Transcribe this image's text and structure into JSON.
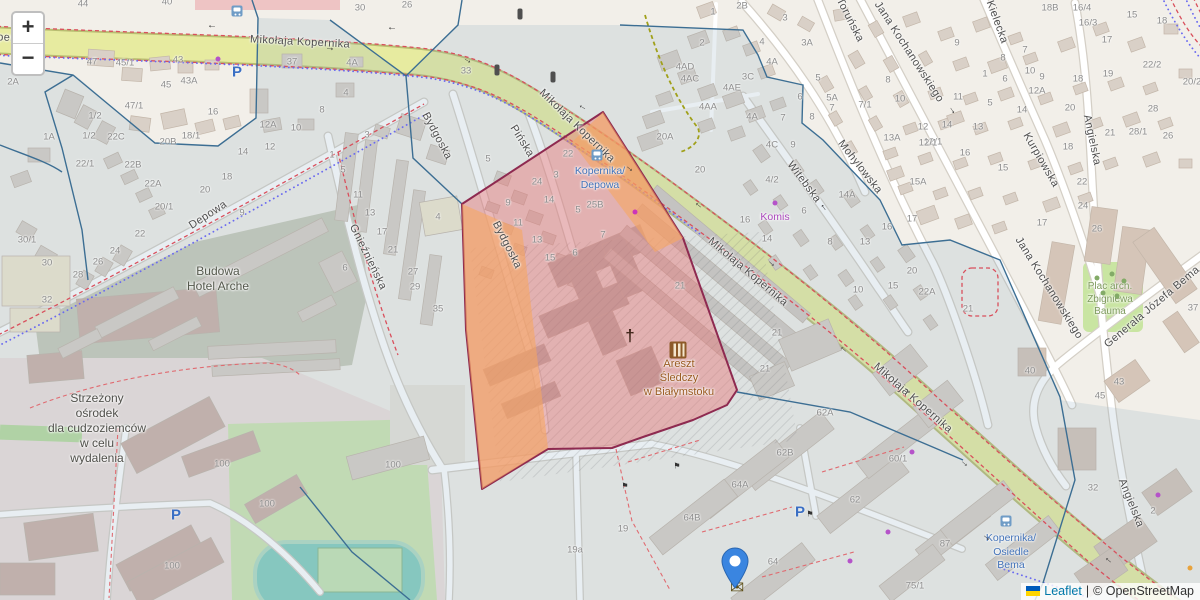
{
  "map": {
    "controls": {
      "zoom_in": "+",
      "zoom_out": "−"
    },
    "attribution": {
      "leaflet": "Leaflet",
      "separator": "|",
      "osm": "© OpenStreetMap",
      "flag_top": "#005BBB",
      "flag_bottom": "#FFD500"
    },
    "colors": {
      "selection_fill": "rgba(234,112,112,0.42)",
      "selection_stroke": "#8e2a50",
      "orange_fill": "rgba(246,166,96,0.6)",
      "marker_blue": "#3a85e0",
      "road_yellow": "#e7eba0"
    },
    "marker": {
      "x": 735,
      "y": 588
    },
    "street_labels": [
      {
        "t": "Mikołaja Kopernika",
        "x": -14,
        "y": 37,
        "r": 2
      },
      {
        "t": "Mikołaja Kopernika",
        "x": 300,
        "y": 42,
        "r": 3
      },
      {
        "t": "Mikołaja Kopernika",
        "x": 577,
        "y": 126,
        "r": 44
      },
      {
        "t": "Mikołaja Kopernika",
        "x": 748,
        "y": 272,
        "r": 40
      },
      {
        "t": "Mikołaja Kopernika",
        "x": 913,
        "y": 398,
        "r": 41
      },
      {
        "t": "Bydgoska",
        "x": 437,
        "y": 136,
        "r": 62
      },
      {
        "t": "Bydgoska",
        "x": 507,
        "y": 245,
        "r": 63
      },
      {
        "t": "Pińska",
        "x": 522,
        "y": 141,
        "r": 58
      },
      {
        "t": "Depowa",
        "x": 208,
        "y": 215,
        "r": -33
      },
      {
        "t": "Gnieźnieńska",
        "x": 368,
        "y": 257,
        "r": 64
      },
      {
        "t": "Witebska",
        "x": 804,
        "y": 182,
        "r": 53
      },
      {
        "t": "Mohylowska",
        "x": 860,
        "y": 167,
        "r": 52
      },
      {
        "t": "Toruńska",
        "x": 850,
        "y": 20,
        "r": 63
      },
      {
        "t": "Jana Kochanowskiego",
        "x": 909,
        "y": 52,
        "r": 57
      },
      {
        "t": "Jana Kochanowskiego",
        "x": 1049,
        "y": 288,
        "r": 58
      },
      {
        "t": "Kielecka",
        "x": 997,
        "y": 22,
        "r": 70
      },
      {
        "t": "Kurpiowska",
        "x": 1041,
        "y": 160,
        "r": 60
      },
      {
        "t": "Angielska",
        "x": 1092,
        "y": 140,
        "r": 78
      },
      {
        "t": "Angielska",
        "x": 1131,
        "y": 503,
        "r": 68
      },
      {
        "t": "Generała Józefa Bema",
        "x": 1152,
        "y": 307,
        "r": -40
      }
    ],
    "place_labels": [
      {
        "name": "construction-label",
        "lines": [
          "Budowa",
          "Hotel Arche"
        ],
        "x": 218,
        "y": 264,
        "color": "#54584c",
        "size": 12,
        "lh": 15
      },
      {
        "name": "detention-centre-label",
        "lines": [
          "Strzeżony",
          "ośrodek",
          "dla cudzoziemców",
          "w celu",
          "wydalenia"
        ],
        "x": 97,
        "y": 391,
        "color": "#4f4f4a",
        "size": 12,
        "lh": 15
      },
      {
        "name": "prison-label",
        "lines": [
          "Areszt",
          "Śledczy",
          "w Białymstoku"
        ],
        "x": 679,
        "y": 357,
        "color": "#9a5b21",
        "size": 11,
        "lh": 14
      },
      {
        "name": "bus-stop-kopernika-depowa",
        "lines": [
          "Kopernika/",
          "Depowa"
        ],
        "x": 600,
        "y": 165,
        "color": "#4272b8",
        "size": 10.5,
        "lh": 13.5
      },
      {
        "name": "bus-stop-kopernika-osiedle-bema",
        "lines": [
          "Kopernika/",
          "Osiedle",
          "Bema"
        ],
        "x": 1011,
        "y": 532,
        "color": "#4272b8",
        "size": 10.5,
        "lh": 13.5
      },
      {
        "name": "shop-komis-label",
        "lines": [
          "Komis"
        ],
        "x": 775,
        "y": 211,
        "color": "#ab47bc",
        "size": 10.5,
        "lh": 13
      },
      {
        "name": "park-bauma-label",
        "lines": [
          "Plac arch.",
          "Zbigniewa",
          "Bauma"
        ],
        "x": 1110,
        "y": 281,
        "color": "#7d9a5c",
        "size": 10,
        "lh": 12.5
      }
    ],
    "house_numbers": [
      [
        83,
        4,
        "44"
      ],
      [
        167,
        2,
        "40"
      ],
      [
        92,
        62,
        "47"
      ],
      [
        125,
        63,
        "45/1"
      ],
      [
        178,
        60,
        "43"
      ],
      [
        166,
        85,
        "45"
      ],
      [
        189,
        81,
        "43A"
      ],
      [
        292,
        62,
        "37"
      ],
      [
        213,
        112,
        "16"
      ],
      [
        134,
        106,
        "47/1"
      ],
      [
        95,
        116,
        "1/2"
      ],
      [
        89,
        136,
        "1/2"
      ],
      [
        49,
        137,
        "1A"
      ],
      [
        116,
        137,
        "22C"
      ],
      [
        268,
        125,
        "12A"
      ],
      [
        296,
        128,
        "10"
      ],
      [
        168,
        142,
        "20B"
      ],
      [
        191,
        136,
        "18/1"
      ],
      [
        13,
        82,
        "2A"
      ],
      [
        85,
        164,
        "22/1"
      ],
      [
        133,
        165,
        "22B"
      ],
      [
        153,
        184,
        "22A"
      ],
      [
        164,
        207,
        "20/1"
      ],
      [
        140,
        234,
        "22"
      ],
      [
        115,
        251,
        "24"
      ],
      [
        98,
        262,
        "26"
      ],
      [
        78,
        275,
        "28"
      ],
      [
        27,
        240,
        "30/1"
      ],
      [
        47,
        263,
        "30"
      ],
      [
        47,
        300,
        "32"
      ],
      [
        322,
        110,
        "8"
      ],
      [
        243,
        152,
        "14"
      ],
      [
        270,
        147,
        "12"
      ],
      [
        227,
        177,
        "18"
      ],
      [
        205,
        190,
        "20"
      ],
      [
        367,
        135,
        "3"
      ],
      [
        332,
        155,
        "1"
      ],
      [
        343,
        170,
        "5"
      ],
      [
        358,
        195,
        "11"
      ],
      [
        370,
        213,
        "13"
      ],
      [
        382,
        232,
        "17"
      ],
      [
        393,
        250,
        "21"
      ],
      [
        413,
        272,
        "27"
      ],
      [
        415,
        287,
        "29"
      ],
      [
        242,
        213,
        "9"
      ],
      [
        345,
        268,
        "6"
      ],
      [
        360,
        8,
        "30"
      ],
      [
        407,
        5,
        "26"
      ],
      [
        352,
        63,
        "4A"
      ],
      [
        346,
        93,
        "4"
      ],
      [
        466,
        71,
        "33"
      ],
      [
        438,
        217,
        "4"
      ],
      [
        438,
        309,
        "35"
      ],
      [
        488,
        159,
        "5"
      ],
      [
        568,
        154,
        "22"
      ],
      [
        537,
        182,
        "24"
      ],
      [
        556,
        175,
        "3"
      ],
      [
        508,
        203,
        "9"
      ],
      [
        549,
        200,
        "14"
      ],
      [
        518,
        223,
        "11"
      ],
      [
        537,
        240,
        "13"
      ],
      [
        550,
        258,
        "15"
      ],
      [
        575,
        253,
        "6"
      ],
      [
        578,
        210,
        "5"
      ],
      [
        595,
        205,
        "25B"
      ],
      [
        603,
        235,
        "7"
      ],
      [
        665,
        137,
        "20A"
      ],
      [
        700,
        170,
        "20"
      ],
      [
        680,
        286,
        "21"
      ],
      [
        777,
        333,
        "21"
      ],
      [
        765,
        369,
        "21"
      ],
      [
        825,
        413,
        "62A"
      ],
      [
        742,
        6,
        "2B"
      ],
      [
        713,
        12,
        "1"
      ],
      [
        702,
        43,
        "2"
      ],
      [
        785,
        18,
        "3"
      ],
      [
        762,
        42,
        "4"
      ],
      [
        772,
        62,
        "4A"
      ],
      [
        748,
        77,
        "3C"
      ],
      [
        807,
        43,
        "3A"
      ],
      [
        685,
        67,
        "4AD"
      ],
      [
        690,
        79,
        "4AC"
      ],
      [
        732,
        88,
        "4AE"
      ],
      [
        708,
        107,
        "4AA"
      ],
      [
        818,
        78,
        "5"
      ],
      [
        832,
        98,
        "5A"
      ],
      [
        800,
        97,
        "6"
      ],
      [
        832,
        108,
        "7"
      ],
      [
        752,
        117,
        "4A"
      ],
      [
        783,
        118,
        "7"
      ],
      [
        812,
        117,
        "8"
      ],
      [
        793,
        145,
        "9"
      ],
      [
        772,
        145,
        "4C"
      ],
      [
        1050,
        8,
        "18B"
      ],
      [
        1082,
        8,
        "16/4"
      ],
      [
        1088,
        23,
        "16/3"
      ],
      [
        1107,
        40,
        "17"
      ],
      [
        1132,
        15,
        "15"
      ],
      [
        1162,
        21,
        "18"
      ],
      [
        957,
        43,
        "9"
      ],
      [
        1003,
        58,
        "8"
      ],
      [
        1025,
        50,
        "7"
      ],
      [
        985,
        74,
        "1"
      ],
      [
        1005,
        79,
        "6"
      ],
      [
        1030,
        71,
        "10"
      ],
      [
        1042,
        77,
        "9"
      ],
      [
        1037,
        91,
        "12A"
      ],
      [
        888,
        80,
        "8"
      ],
      [
        900,
        99,
        "10"
      ],
      [
        865,
        105,
        "7/1"
      ],
      [
        958,
        97,
        "11"
      ],
      [
        990,
        103,
        "5"
      ],
      [
        1022,
        110,
        "14"
      ],
      [
        978,
        127,
        "13"
      ],
      [
        947,
        125,
        "14"
      ],
      [
        923,
        127,
        "12"
      ],
      [
        933,
        142,
        "12/1"
      ],
      [
        892,
        138,
        "13A"
      ],
      [
        965,
        153,
        "16"
      ],
      [
        1068,
        147,
        "18"
      ],
      [
        1070,
        108,
        "20"
      ],
      [
        1078,
        79,
        "18"
      ],
      [
        1108,
        74,
        "19"
      ],
      [
        1152,
        65,
        "22/2"
      ],
      [
        1192,
        82,
        "20/2"
      ],
      [
        1153,
        109,
        "28"
      ],
      [
        1110,
        133,
        "21"
      ],
      [
        1138,
        132,
        "28/1"
      ],
      [
        1168,
        136,
        "26"
      ],
      [
        1003,
        168,
        "15"
      ],
      [
        918,
        182,
        "15A"
      ],
      [
        1082,
        182,
        "22"
      ],
      [
        847,
        195,
        "14A"
      ],
      [
        772,
        180,
        "4/2"
      ],
      [
        745,
        220,
        "16"
      ],
      [
        804,
        211,
        "6"
      ],
      [
        767,
        239,
        "14"
      ],
      [
        830,
        242,
        "8"
      ],
      [
        865,
        242,
        "13"
      ],
      [
        912,
        219,
        "17"
      ],
      [
        887,
        227,
        "16"
      ],
      [
        912,
        271,
        "20"
      ],
      [
        893,
        286,
        "15"
      ],
      [
        858,
        290,
        "10"
      ],
      [
        927,
        292,
        "22A"
      ],
      [
        968,
        309,
        "21"
      ],
      [
        928,
        143,
        "12/1"
      ],
      [
        1083,
        206,
        "24"
      ],
      [
        1097,
        229,
        "26"
      ],
      [
        1042,
        223,
        "17"
      ],
      [
        1193,
        308,
        "37"
      ],
      [
        1030,
        371,
        "40"
      ],
      [
        1119,
        382,
        "43"
      ],
      [
        1100,
        396,
        "45"
      ],
      [
        785,
        453,
        "62B"
      ],
      [
        740,
        485,
        "64A"
      ],
      [
        692,
        518,
        "64B"
      ],
      [
        855,
        500,
        "62"
      ],
      [
        773,
        562,
        "64"
      ],
      [
        623,
        529,
        "19"
      ],
      [
        898,
        459,
        "60/1"
      ],
      [
        945,
        544,
        "87"
      ],
      [
        915,
        586,
        "75/1"
      ],
      [
        575,
        550,
        "19a"
      ],
      [
        222,
        464,
        "100"
      ],
      [
        267,
        504,
        "100"
      ],
      [
        172,
        566,
        "100"
      ],
      [
        393,
        465,
        "100"
      ],
      [
        1093,
        488,
        "32"
      ],
      [
        1153,
        511,
        "2"
      ]
    ],
    "icons": [
      {
        "type": "bus",
        "x": 237,
        "y": 11
      },
      {
        "type": "bus",
        "x": 597,
        "y": 155
      },
      {
        "type": "bus",
        "x": 1006,
        "y": 521
      },
      {
        "type": "parking",
        "label": "P",
        "x": 800,
        "y": 512
      },
      {
        "type": "parking",
        "label": "P",
        "x": 176,
        "y": 515
      },
      {
        "type": "parking",
        "label": "P",
        "x": 237,
        "y": 72
      },
      {
        "type": "traffic-light",
        "x": 520,
        "y": 14
      },
      {
        "type": "traffic-light",
        "x": 497,
        "y": 70
      },
      {
        "type": "traffic-light",
        "x": 553,
        "y": 77
      },
      {
        "type": "church",
        "glyph": "†",
        "x": 630,
        "y": 336
      },
      {
        "type": "prison",
        "x": 678,
        "y": 350
      },
      {
        "type": "post",
        "glyph": "✉",
        "x": 737,
        "y": 588
      },
      {
        "type": "flag",
        "glyph": "⚑",
        "x": 677,
        "y": 466
      },
      {
        "type": "flag",
        "glyph": "⚑",
        "x": 625,
        "y": 486
      },
      {
        "type": "flag",
        "glyph": "⚑",
        "x": 810,
        "y": 514
      }
    ],
    "arrows": [
      [
        212,
        27,
        180
      ],
      [
        392,
        29,
        180
      ],
      [
        330,
        48,
        3
      ],
      [
        468,
        60,
        30
      ],
      [
        582,
        108,
        210
      ],
      [
        630,
        168,
        40
      ],
      [
        698,
        206,
        220
      ],
      [
        772,
        263,
        42
      ],
      [
        843,
        350,
        222
      ],
      [
        908,
        390,
        42
      ],
      [
        965,
        463,
        42
      ],
      [
        987,
        537,
        40
      ],
      [
        1108,
        561,
        220
      ],
      [
        823,
        208,
        235
      ],
      [
        953,
        110,
        57
      ]
    ],
    "dots": [
      [
        218,
        59,
        "#b553c9"
      ],
      [
        635,
        212,
        "#cc35b9"
      ],
      [
        775,
        203,
        "#b553c9"
      ],
      [
        888,
        532,
        "#b553c9"
      ],
      [
        850,
        561,
        "#b553c9"
      ],
      [
        1158,
        495,
        "#b553c9"
      ],
      [
        912,
        452,
        "#b553c9"
      ],
      [
        1190,
        568,
        "#e8a33d"
      ]
    ],
    "trees": [
      [
        1097,
        278
      ],
      [
        1112,
        274
      ],
      [
        1124,
        281
      ],
      [
        1103,
        293
      ],
      [
        1117,
        296
      ]
    ]
  }
}
